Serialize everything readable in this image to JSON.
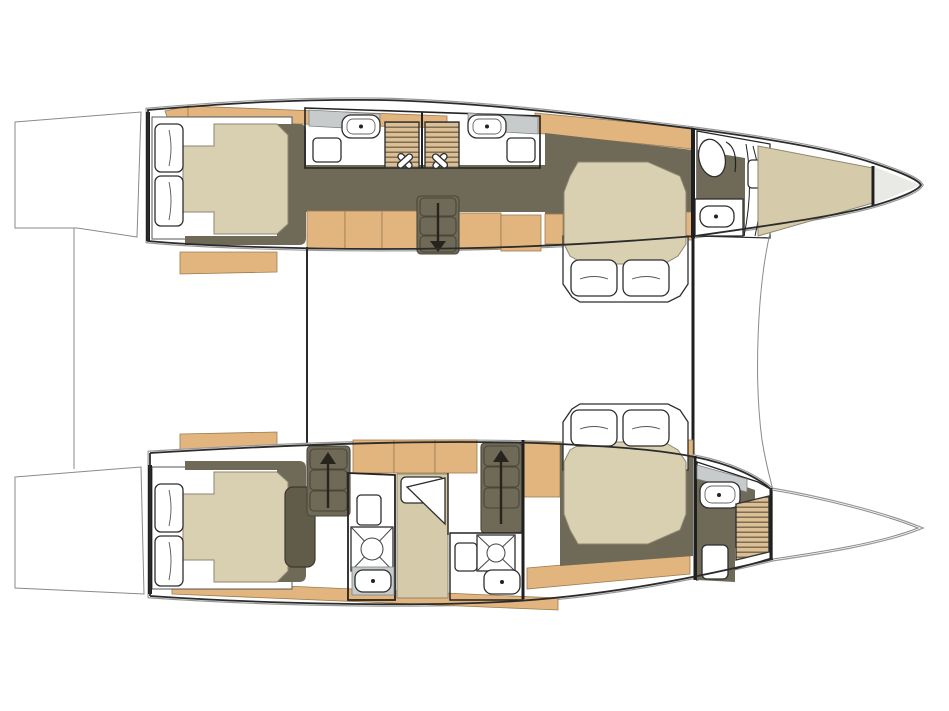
{
  "diagram": {
    "kind": "floor-plan",
    "subject": "catamaran-yacht-interior-layout",
    "view": "overhead-deck-plan"
  },
  "colors": {
    "paper": "#ffffff",
    "wood": "#e2b47e",
    "louver": "#dcbf94",
    "slat": "#6d5f49",
    "floor": "#6f6957",
    "floorDark": "#615b4a",
    "mattress": "#d9cfb1",
    "berth": "#d5caa9",
    "bowtip": "#e9e9e6",
    "counter": "#c7cbcc",
    "grayFloor": "#c3c3c3",
    "line": "#1f1f1f"
  },
  "icons": {
    "stairs_down": "down-arrow",
    "stairs_up": "up-arrow",
    "sink": "basin-with-faucet-dot",
    "shower_tray": "square-x-with-drain-circle",
    "shower_handle": "crossed-door-handles"
  },
  "rooms": {
    "port_hull": [
      "aft-cabin",
      "aft-bathroom",
      "mid-bathroom",
      "companionway-stairs-down",
      "forward-cabin-island-bed",
      "bow-bathroom",
      "bow-berth",
      "anchor-locker"
    ],
    "starboard_hull": [
      "aft-cabin",
      "bathroom-1",
      "single-berth-cabin",
      "stairs-up-aft",
      "stairs-up-mid",
      "bathroom-2",
      "forward-cabin-island-bed",
      "bow-bathroom",
      "bow-locker"
    ],
    "bridge": [
      "aft-bulkhead",
      "forward-bulkhead",
      "coachroof-windshield-curve",
      "stern-platforms"
    ]
  }
}
